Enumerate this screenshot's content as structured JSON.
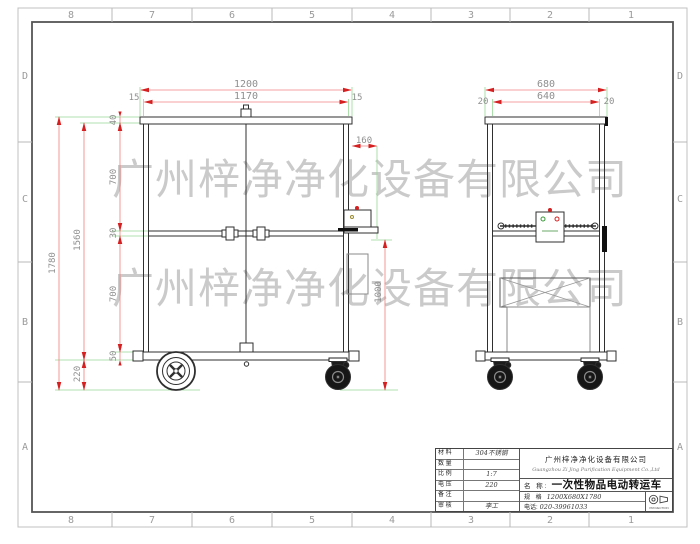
{
  "sheet": {
    "cols": [
      "8",
      "7",
      "6",
      "5",
      "4",
      "3",
      "2",
      "1"
    ],
    "rows": [
      "D",
      "C",
      "B",
      "A"
    ]
  },
  "watermark": {
    "text": "广州梓净净化设备有限公司"
  },
  "front": {
    "dims": {
      "overall_w": "1200",
      "inner_w": "1170",
      "edge_l": "15",
      "edge_r": "15",
      "top": "40",
      "upper": "700",
      "mid": "30",
      "lower": "700",
      "base": "50",
      "frame_h": "1560",
      "overall_h": "1780",
      "wheel_h": "220",
      "box_offset": "160",
      "box_h": "1000"
    }
  },
  "side": {
    "dims": {
      "overall_w": "680",
      "inner_w": "640",
      "edge_l": "20",
      "edge_r": "20"
    }
  },
  "title_block": {
    "rows": [
      {
        "label": "材 料",
        "value": "304不锈钢"
      },
      {
        "label": "数 量",
        "value": ""
      },
      {
        "label": "比 例",
        "value": "1:7"
      },
      {
        "label": "电 压",
        "value": "220"
      },
      {
        "label": "备 注",
        "value": ""
      },
      {
        "label": "审 核",
        "value": "李工"
      }
    ],
    "company_cn": "广州梓净净化设备有限公司",
    "company_en": "Guangzhou Zi Jing Purification Equipment Co.,Ltd",
    "name_label": "名  称:",
    "name_value": "一次性物品电动转运车",
    "spec_label": "规  格",
    "spec_value": "1200X680X1780",
    "phone_label": "电话:",
    "phone_value": "020-39961033",
    "projection": "PROJECTION"
  },
  "colors": {
    "dim_line": "#f08080",
    "dim_arrow": "#d42020",
    "ext_line": "#96d896",
    "dim_text": "#8f8f8f",
    "drawing_line": "#2f2f2f",
    "watermark": "#9f9f9f"
  }
}
